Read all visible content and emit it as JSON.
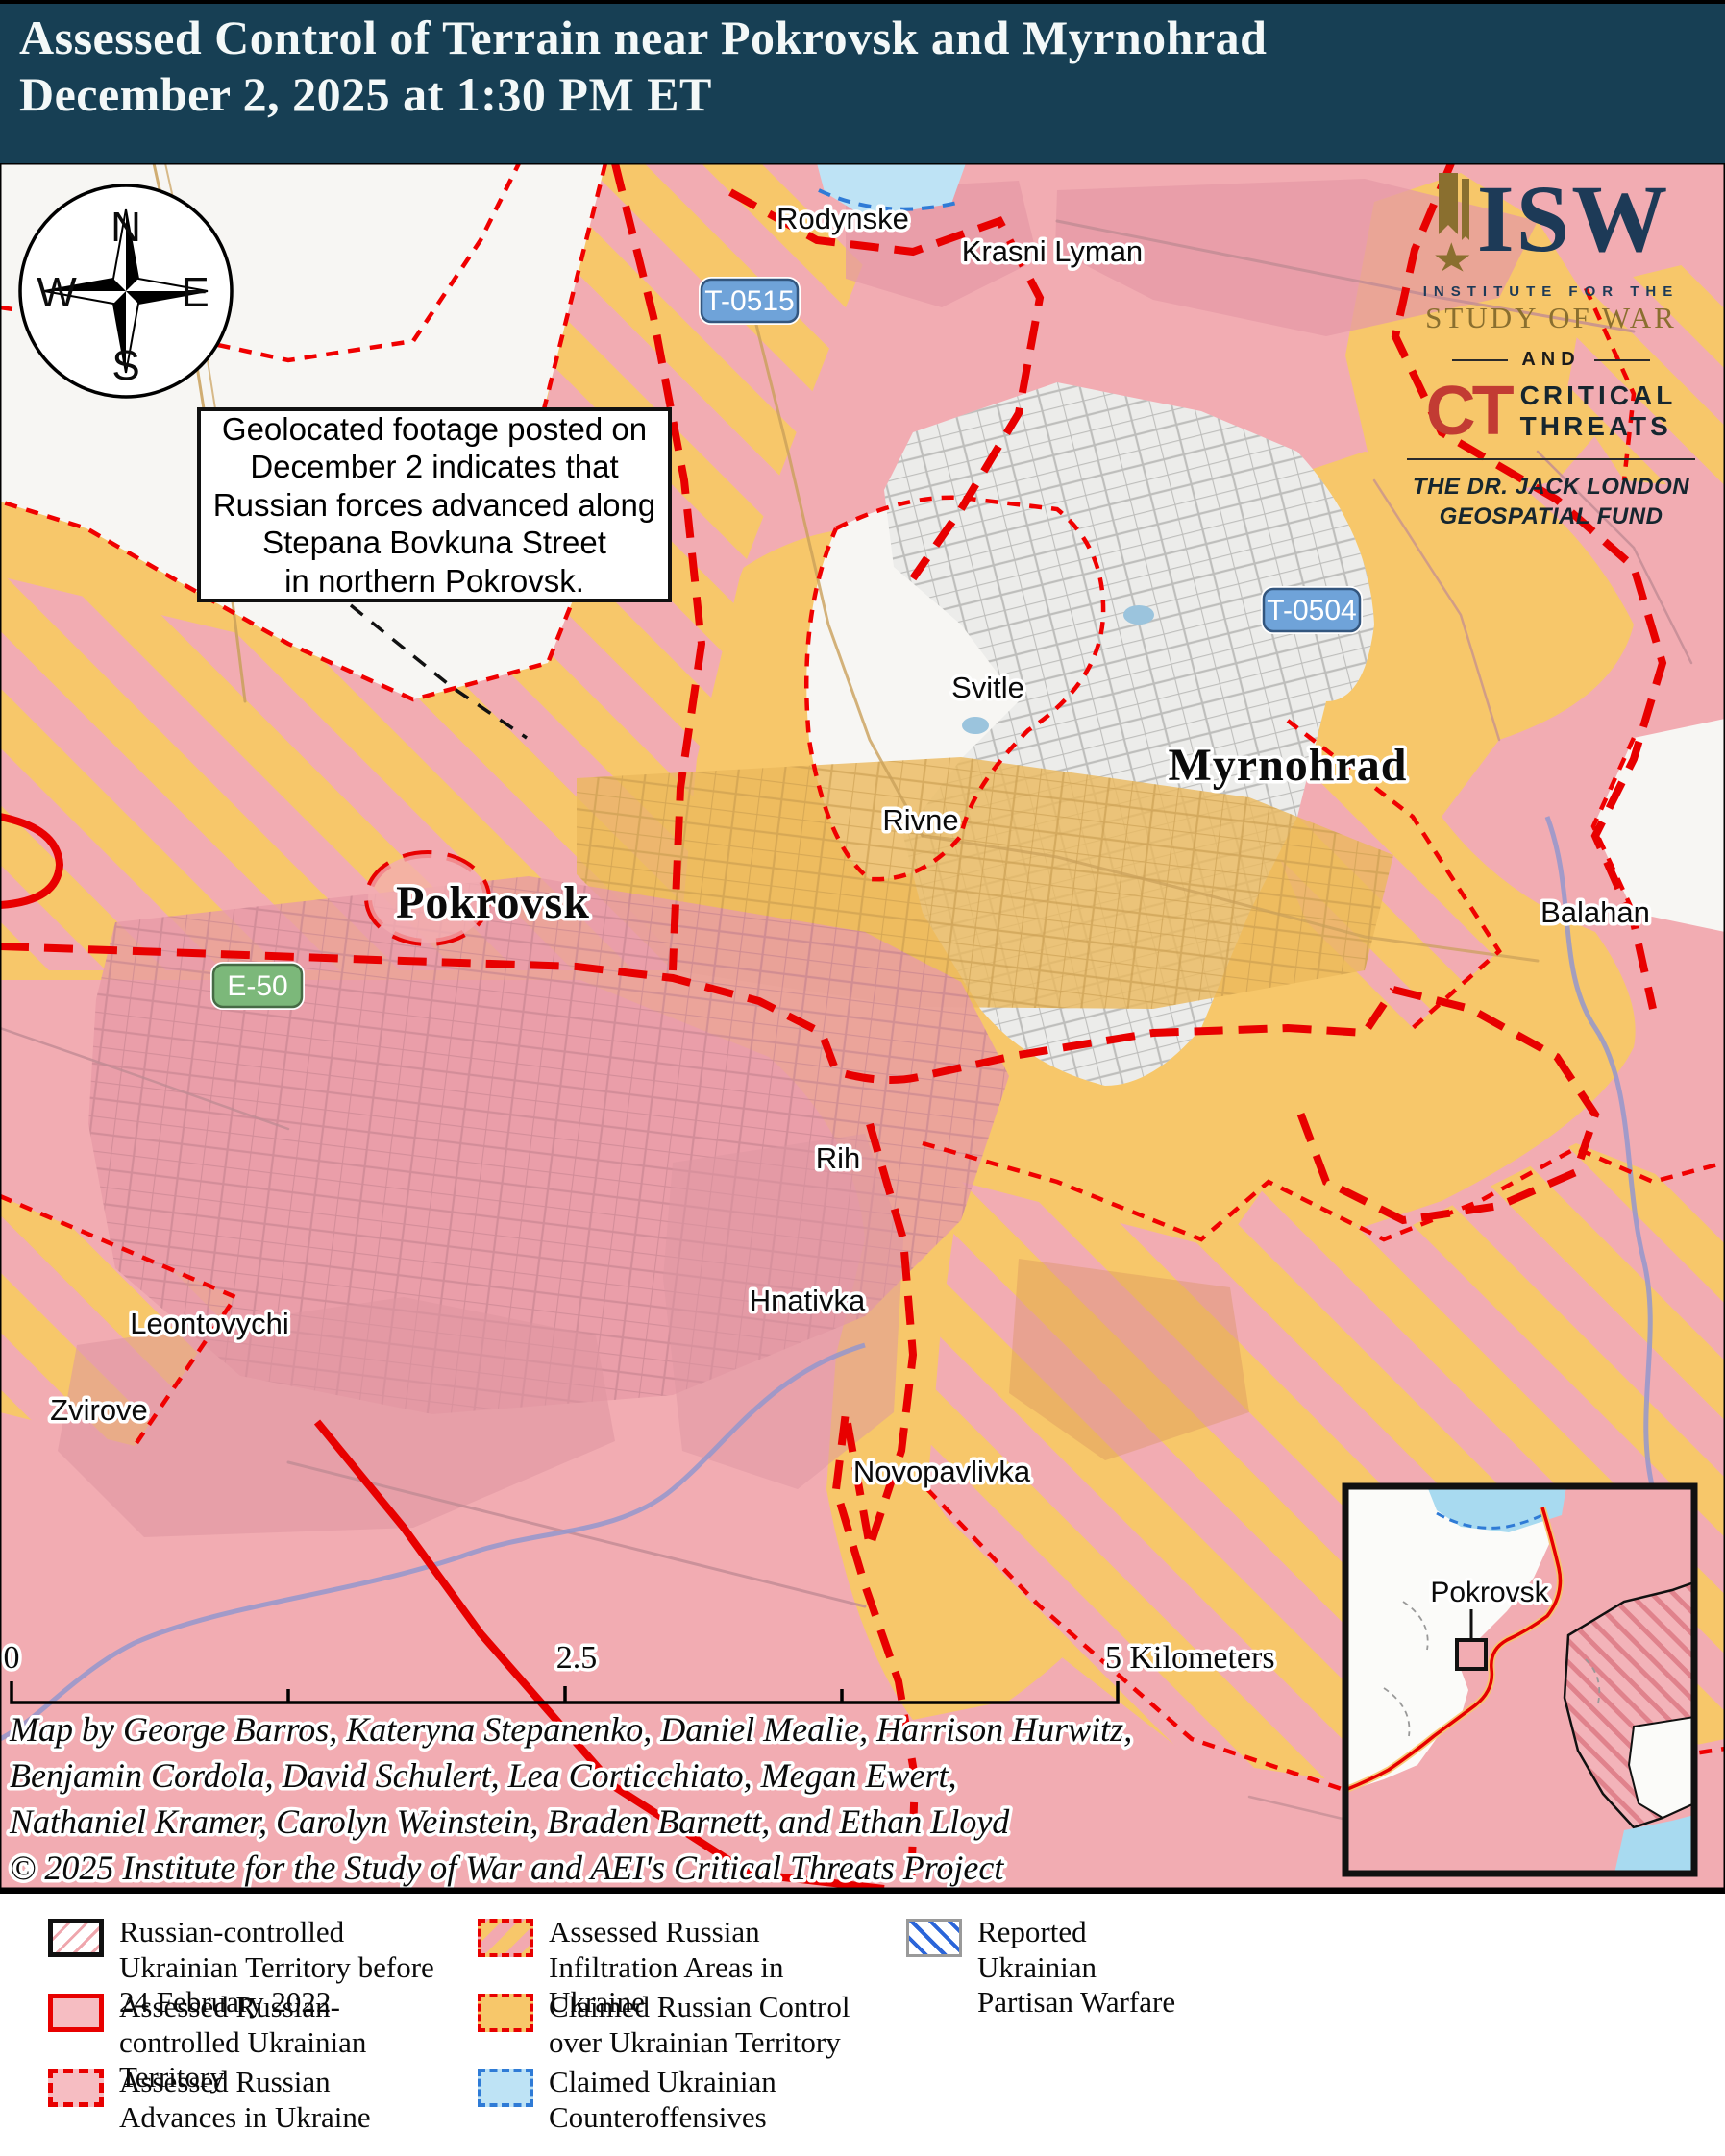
{
  "header": {
    "line1": "Assessed Control of Terrain near Pokrovsk and Myrnohrad",
    "line2": "December 2, 2025 at 1:30 PM ET"
  },
  "branding": {
    "isw_acronym": "ISW",
    "isw_small": "INSTITUTE FOR THE",
    "isw_name": "STUDY OF WAR",
    "and_label": "AND",
    "ct_acronym": "CT",
    "ct_word1": "CRITICAL",
    "ct_word2": "THREATS",
    "fund_line1": "THE DR. JACK LONDON",
    "fund_line2": "GEOSPATIAL FUND"
  },
  "compass": {
    "n": "N",
    "e": "E",
    "s": "S",
    "w": "W"
  },
  "annotation": {
    "lines": [
      "Geolocated footage posted on",
      "December 2 indicates that",
      "Russian forces advanced along",
      "Stepana Bovkuna Street",
      "in northern Pokrovsk."
    ]
  },
  "map": {
    "cities": [
      {
        "name": "Pokrovsk"
      },
      {
        "name": "Myrnohrad"
      }
    ],
    "towns": [
      "Rodynske",
      "Krasni Lyman",
      "Svitle",
      "Rivne",
      "Balahan",
      "Rih",
      "Hnativka",
      "Leontovychi",
      "Zvirove",
      "Novopavlivka"
    ],
    "road_shields": [
      {
        "id": "T-0515",
        "type": "blue"
      },
      {
        "id": "T-0504",
        "type": "blue"
      },
      {
        "id": "E-50",
        "type": "green"
      }
    ]
  },
  "scale_bar": {
    "start": "0",
    "middle": "2.5",
    "end": "5 Kilometers"
  },
  "credits": {
    "lines": [
      "Map by George Barros, Kateryna Stepanenko, Daniel Mealie, Harrison Hurwitz,",
      "Benjamin Cordola, David Schulert, Lea Corticchiato, Megan Ewert,",
      "Nathaniel Kramer, Carolyn Weinstein, Braden Barnett, and Ethan Lloyd",
      "© 2025 Institute for the Study of War and AEI's Critical Threats Project"
    ]
  },
  "inset": {
    "label": "Pokrovsk"
  },
  "legend": {
    "items": [
      {
        "label": "Russian-controlled Ukrainian Territory before 24 February 2022",
        "swatch": "pre2022"
      },
      {
        "label": "Assessed Russian-controlled Ukrainian Territory",
        "swatch": "controlled"
      },
      {
        "label": "Assessed Russian Advances in Ukraine",
        "swatch": "advances"
      },
      {
        "label": "Assessed Russian Infiltration Areas in Ukraine",
        "swatch": "infiltration"
      },
      {
        "label": "Claimed Russian Control over Ukrainian Territory",
        "swatch": "claimed"
      },
      {
        "label": "Claimed Ukrainian Counteroffensives",
        "swatch": "counteroffensive"
      },
      {
        "label": "Reported Ukrainian Partisan Warfare",
        "swatch": "partisan"
      }
    ]
  },
  "colors": {
    "header_bg": "#173F54",
    "russian_controlled": "#F2ACB2",
    "claimed_orange": "#F7C76A",
    "counteroffensive": "#BEE3F5",
    "advance_red": "#E80000",
    "partisan_blue": "#2B65D9",
    "water_blue": "#9497CD",
    "urban_gray": "#ECECEA",
    "white_area": "#F7F6F3",
    "shield_blue": "#6FA3D9",
    "shield_green": "#7CB87A",
    "isw_navy": "#1D3A57",
    "isw_gold": "#8A6F2F",
    "ct_red": "#C23B33"
  }
}
